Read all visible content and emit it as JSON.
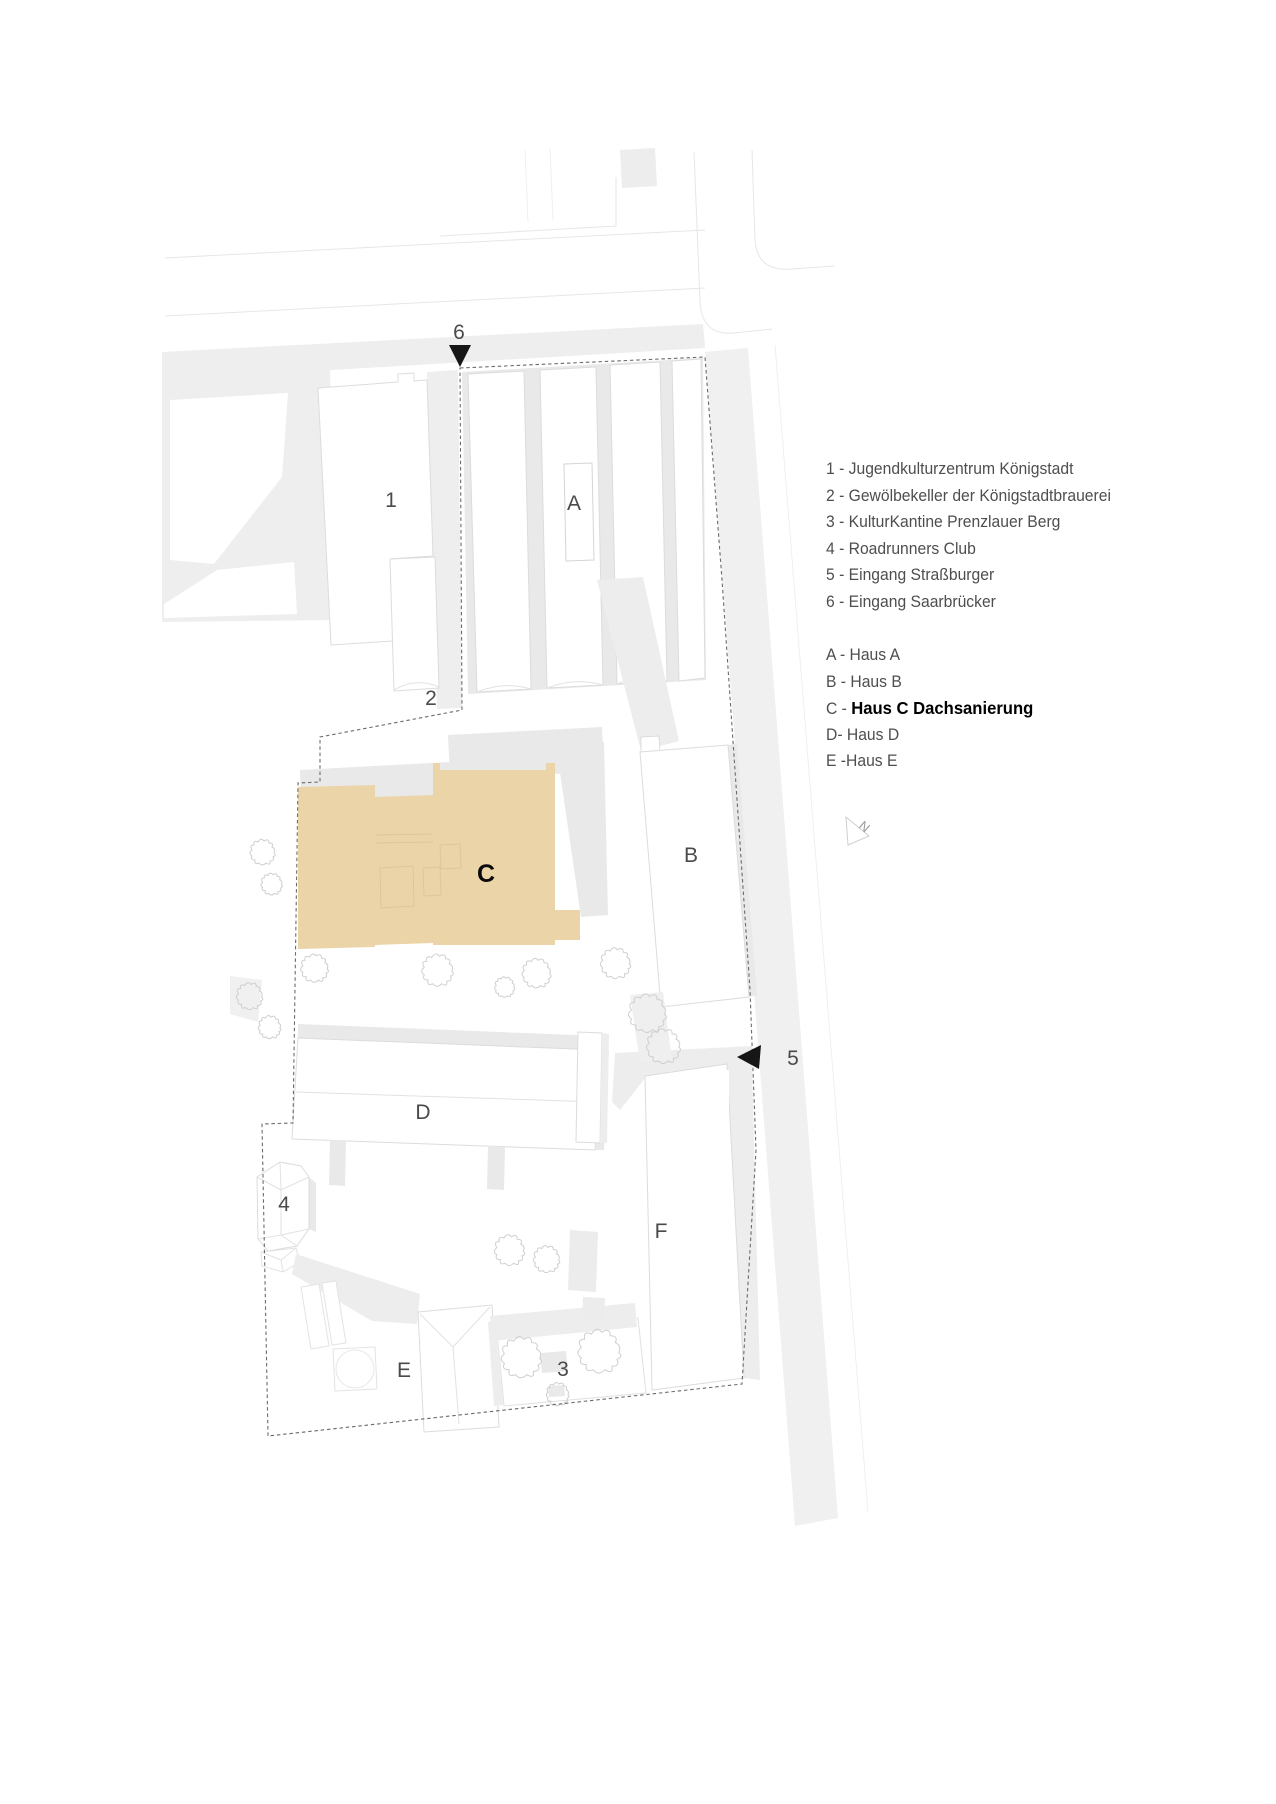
{
  "plan": {
    "labels": {
      "n1": "1",
      "n2": "2",
      "n3": "3",
      "n4": "4",
      "n5": "5",
      "n6": "6",
      "hA": "A",
      "hB": "B",
      "hC": "C",
      "hD": "D",
      "hE": "E",
      "hF": "F"
    },
    "compass_north": "N",
    "highlight_color": "#ebd5a8",
    "marker_color": "#161616"
  },
  "legend": {
    "numbered": [
      "1 - Jugendkulturzentrum Königstadt",
      "2 - Gewölbekeller der Königstadtbrauerei",
      "3 - KulturKantine Prenzlauer Berg",
      "4 - Roadrunners Club",
      "5 - Eingang Straßburger",
      "6 - Eingang Saarbrücker"
    ],
    "lettered_before": [
      "A - Haus A",
      "B - Haus B"
    ],
    "highlight_prefix": "C - ",
    "highlight_label": "Haus C Dachsanierung",
    "lettered_after": [
      "D- Haus D",
      "E -Haus E"
    ]
  }
}
